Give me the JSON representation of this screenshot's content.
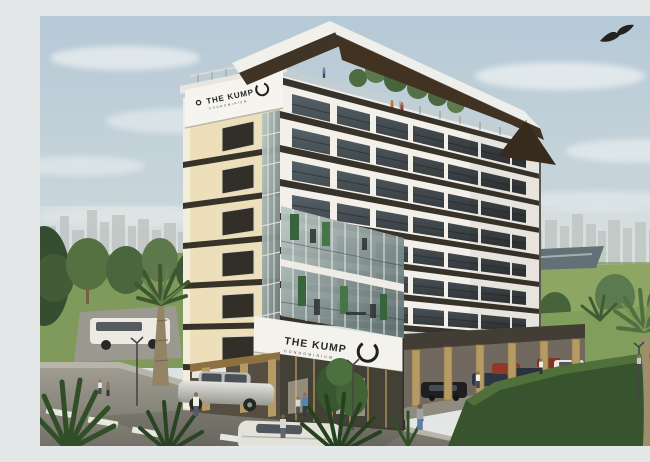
{
  "meta": {
    "image_type": "3D architectural exterior rendering",
    "subject": "THE KUMP condominium building, corner street view"
  },
  "signs": {
    "rooftop": {
      "name": "THE KUMP",
      "subtitle": "CONDOMINIUM"
    },
    "podium": {
      "name": "THE KUMP",
      "subtitle": "CONDOMINIUM"
    }
  },
  "building": {
    "name": "THE KUMP",
    "type": "condominium",
    "storeys_visible": 8,
    "features": [
      "dark angled rooftop canopy with white fascia",
      "rooftop garden terrace with trees and railing",
      "cream side facade with stacked windows",
      "white balconied residential floors with dark floor bands",
      "two-storey corner glass fitness atrium with vertical gardens",
      "white podium sign band with circular logo",
      "ground-floor glass lobby",
      "open-air parking on tan stilt columns"
    ]
  },
  "environment": {
    "sky": "pale blue with soft clouds",
    "bird": "eagle soaring at top right",
    "background": "hazy city skyline on both horizons, park trees, pond at right",
    "foreground": "asphalt road with lane markings, lawns, hedges, palm trees, street lamps, pedestrians"
  },
  "vehicles": [
    "white van (left)",
    "silver sedan (entrance)",
    "white sedan (foreground road)",
    "black sedan (parking)",
    "navy sedan (parking)",
    "red car (parking)",
    "navy sedan 2 (parking)",
    "maroon car (parking)",
    "white sedan (parking)"
  ],
  "palette": {
    "sky_top": "#b7cad9",
    "sky_horizon": "#e4e8e8",
    "wall_white": "#f3f1ea",
    "wall_cream": "#ecdfb9",
    "floor_band": "#2f2a22",
    "canopy_dark": "#38291a",
    "glass_dark": "#3c4a4e",
    "column_tan": "#b4965f",
    "lawn_green": "#7a9655",
    "hedge_green": "#2f4c27",
    "road_gray": "#8b8880",
    "logo_black": "#161616"
  }
}
